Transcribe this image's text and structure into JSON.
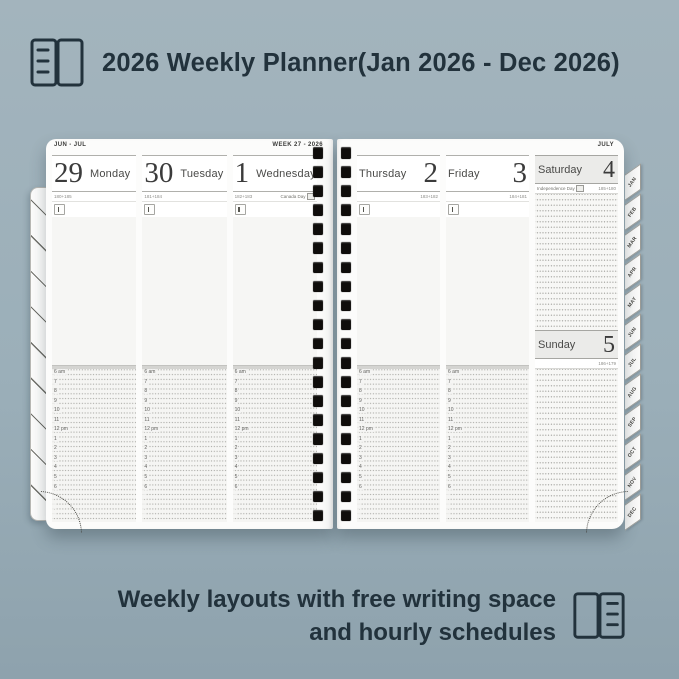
{
  "colors": {
    "background": "#9bafb9",
    "ink": "#22323c",
    "page": "#fcfcfb",
    "page_tint": "#f6f6f4",
    "header_gray": "#ebebe9",
    "rule": "#b0b0ac",
    "dots": "#adada9",
    "binding_hole": "#0f0d0b"
  },
  "header": {
    "title": "2026 Weekly Planner(Jan 2026 - Dec 2026)",
    "icon": "open-book-icon"
  },
  "footer": {
    "line1": "Weekly layouts with free writing space",
    "line2": "and hourly schedules",
    "icon": "open-book-icon"
  },
  "planner": {
    "left_page": {
      "month_range": "JUN - JUL",
      "week_label": "WEEK 27 - 2026",
      "days": [
        {
          "date": "29",
          "name": "Monday",
          "count": "180+185",
          "holiday": ""
        },
        {
          "date": "30",
          "name": "Tuesday",
          "count": "181+184",
          "holiday": ""
        },
        {
          "date": "1",
          "name": "Wednesday",
          "count": "182+183",
          "holiday": "Canada Day"
        }
      ]
    },
    "right_page": {
      "month_label": "JULY",
      "days": [
        {
          "date": "2",
          "name": "Thursday",
          "count": "183+182",
          "holiday": ""
        },
        {
          "date": "3",
          "name": "Friday",
          "count": "184+181",
          "holiday": ""
        }
      ],
      "weekend": {
        "saturday": {
          "date": "4",
          "name": "Saturday",
          "count": "185+180",
          "holiday": "Independence Day"
        },
        "sunday": {
          "date": "5",
          "name": "Sunday",
          "count": "186+179",
          "holiday": ""
        }
      }
    },
    "hours": [
      "6 am",
      "7",
      "8",
      "9",
      "10",
      "11",
      "12 pm",
      "1",
      "2",
      "3",
      "4",
      "5",
      "6",
      "",
      "",
      ""
    ],
    "month_tabs": [
      "JAN",
      "FEB",
      "MAR",
      "APR",
      "MAY",
      "JUN",
      "JUL",
      "AUG",
      "SEP",
      "OCT",
      "NOV",
      "DEC"
    ]
  }
}
